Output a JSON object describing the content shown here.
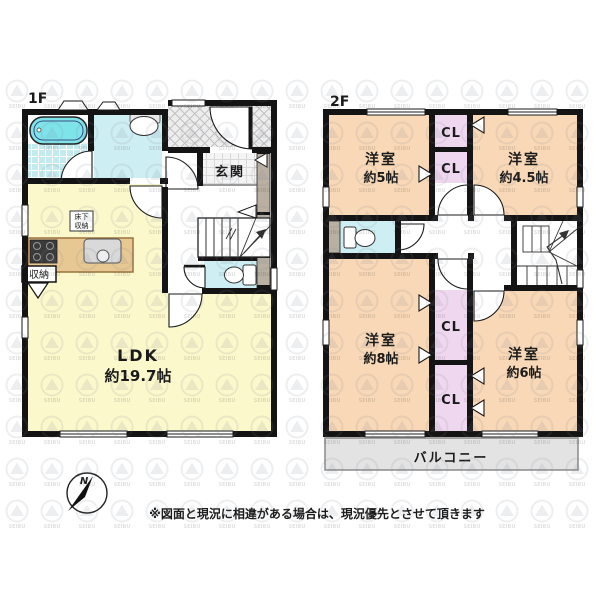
{
  "floor1": {
    "title": "1F",
    "ldk": {
      "name": "LDK",
      "size": "約19.7帖"
    },
    "genkan": "玄関",
    "underfloor_storage": {
      "line1": "床下",
      "line2": "収納"
    },
    "storage": "収納"
  },
  "floor2": {
    "title": "2F",
    "room_tl": {
      "name": "洋室",
      "size": "約5帖"
    },
    "room_tr": {
      "name": "洋室",
      "size": "約4.5帖"
    },
    "room_bl": {
      "name": "洋室",
      "size": "約8帖"
    },
    "room_br": {
      "name": "洋室",
      "size": "約6帖"
    },
    "closet_label": "CL",
    "balcony": "バルコニー"
  },
  "compass": {
    "north": "N"
  },
  "note": "※図面と現況に相違がある場合は、現況優先とさせて頂きます",
  "watermark": {
    "text": "SEIBU"
  },
  "colors": {
    "wall": "#141414",
    "room_yellow": "#fbf8cc",
    "room_peach": "#f8d8b6",
    "closet_pink": "#efd8ef",
    "wet_cyan": "#cdeef2",
    "tub_cyan": "#7fe3ea",
    "cabinet_gray": "#b9b0a2",
    "balcony_gray": "#e3e3e3",
    "counter_tan": "#e7c892"
  }
}
